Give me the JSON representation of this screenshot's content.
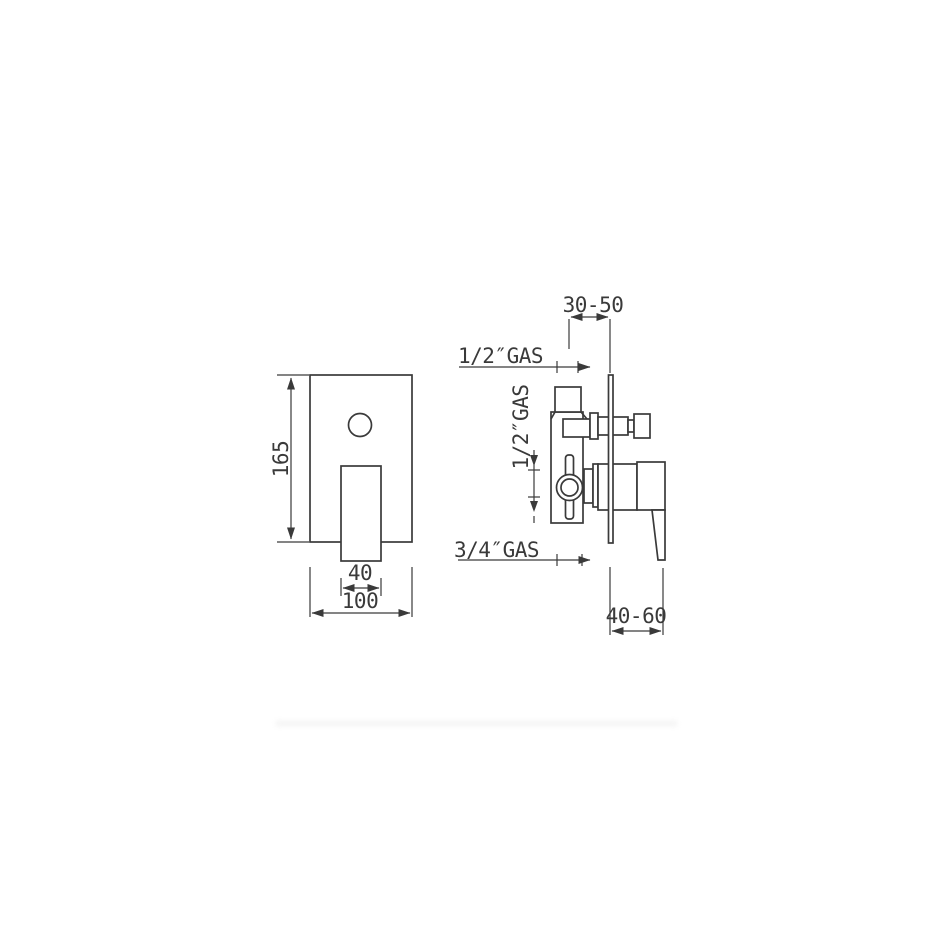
{
  "drawing_title": "concealed-shower-mixer-technical-drawing",
  "colors": {
    "line": "#3a3a3a",
    "background": "#ffffff",
    "shadow_band": "#f6f6f6"
  },
  "front_view": {
    "height_dim": "165",
    "plate_width_dim": "100",
    "lever_width_dim": "40"
  },
  "side_view": {
    "wall_depth_dim": "30-50",
    "plate_range_dim": "40-60",
    "shower_outlet_label": "1/2″GAS",
    "inlet_label": "1/2″GAS",
    "spout_outlet_label": "3/4″GAS"
  }
}
